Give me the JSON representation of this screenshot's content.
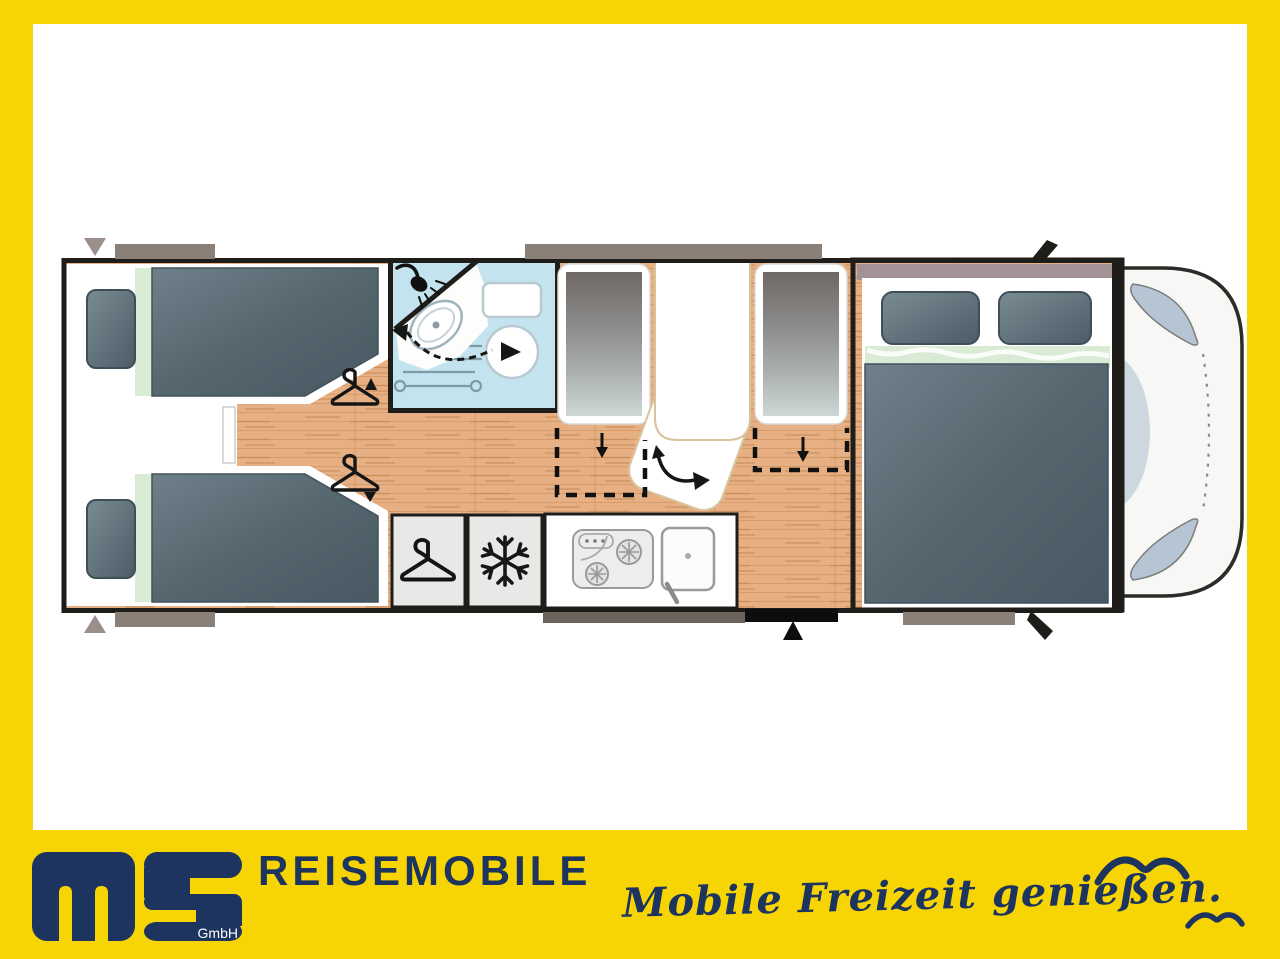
{
  "brand": {
    "logo_main": "ms",
    "logo_suffix": "GmbH",
    "wordmark": "REISEMOBILE",
    "tagline": "Mobile Freizeit genießen."
  },
  "colors": {
    "frame_yellow": "#f7d504",
    "brand_navy": "#1d345f",
    "wall_black": "#1f1d1a",
    "floor_wood": "#e6b084",
    "wood_grain": "#c68a55",
    "bathroom_blue": "#c3e4ef",
    "mattress_slate": "#5a6b75",
    "bedding_green": "#d9ead5",
    "bench_gray": "#8f8f8d",
    "window_gray": "#8b8077",
    "cab_band_mauve": "#a29296",
    "unit_gray": "#e8e8e6",
    "cab_window_blue": "#b6c5d4"
  },
  "floorplan": {
    "icons": {
      "snowflake_glyph": "❄",
      "hanger-icon": "clothes-hanger outline (wardrobe)",
      "snowflake-icon": "snowflake (fridge/freezer)",
      "shower-head-icon": "shower head with spray",
      "swivel-arrow-icon": "dashed curved double arrow (swivel washbasin)",
      "rotate-arrow-icon": "curved arrow (swivelling table)",
      "dropdown-arrow-icon": "down arrow (drop-down bed)",
      "entry-arrow-icon": "solid up triangle (entrance door)",
      "seagull-icon": "brush-stroke gull silhouette",
      "rear-marker-arrow": "small gray triangle marker"
    }
  }
}
